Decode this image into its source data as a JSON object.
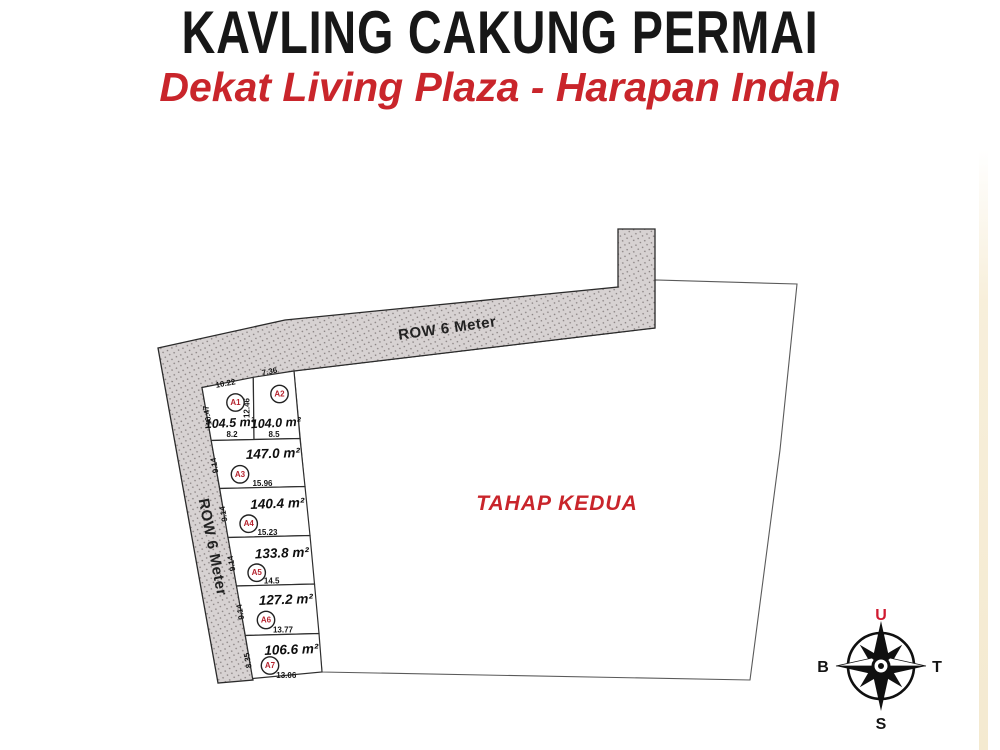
{
  "header": {
    "title": "KAVLING CAKUNG PERMAI",
    "subtitle": "Dekat Living Plaza - Harapan Indah"
  },
  "site_plan": {
    "phase_label": "TAHAP KEDUA",
    "road_label_top": "ROW 6 Meter",
    "road_label_left": "ROW 6 Meter",
    "plots": [
      {
        "id": "A1",
        "area": "104.5 m²",
        "dim_top": "10.22",
        "dim_left": "10.47",
        "dim_right": "12.46",
        "dim_bottom": "8.2"
      },
      {
        "id": "A2",
        "area": "104.0 m²",
        "dim_top": "7.36",
        "dim_bottom": "8.5"
      },
      {
        "id": "A3",
        "area": "147.0 m²",
        "dim_left": "9.14",
        "dim_bottom": "15.96"
      },
      {
        "id": "A4",
        "area": "140.4 m²",
        "dim_left": "9.14",
        "dim_bottom": "15.23"
      },
      {
        "id": "A5",
        "area": "133.8 m²",
        "dim_left": "9.14",
        "dim_bottom": "14.5"
      },
      {
        "id": "A6",
        "area": "127.2 m²",
        "dim_left": "9.14",
        "dim_bottom": "13.77"
      },
      {
        "id": "A7",
        "area": "106.6 m²",
        "dim_left": "8.35",
        "dim_bottom": "13.06"
      }
    ]
  },
  "compass": {
    "north_label": "U",
    "east_label": "T",
    "south_label": "S",
    "west_label": "B"
  },
  "colors": {
    "accent_red": "#c9252b",
    "road_fill": "#d7d2d2",
    "outline": "#2e2e2e"
  }
}
